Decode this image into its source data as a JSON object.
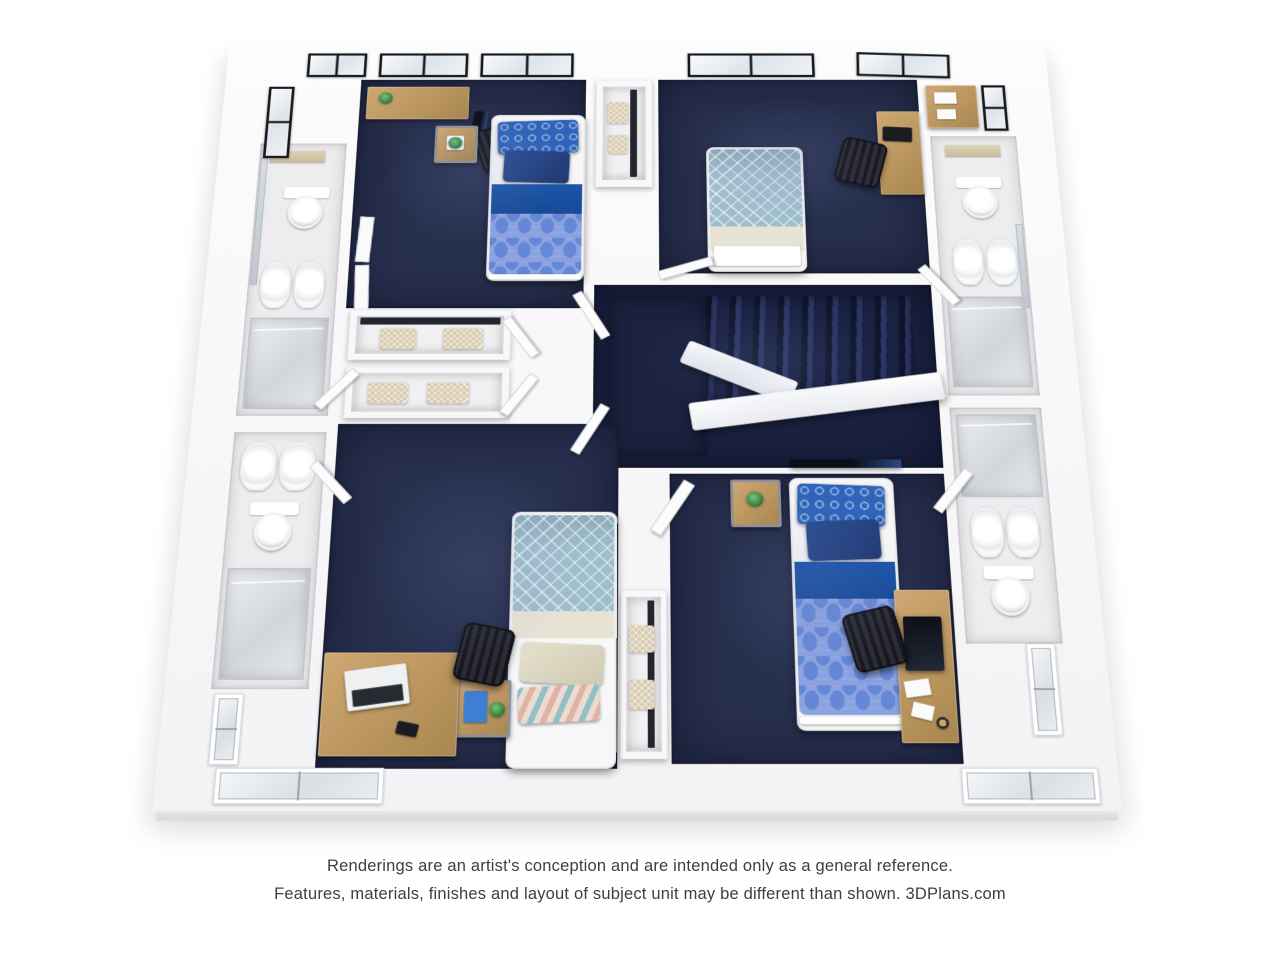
{
  "caption": {
    "line1": "Renderings are an artist's conception and are intended only as a general reference.",
    "line2": "Features, materials, finishes and layout of subject unit may be different than shown. 3DPlans.com"
  },
  "colors": {
    "page_bg": "#ffffff",
    "caption_text": "#3e3e3e",
    "carpet": "#28304f",
    "carpet_dark": "#1b2240",
    "tile": "#ededf0",
    "wood": "#cfa873",
    "wood_dark": "#a9864f",
    "frame_dark": "#17181d",
    "bed_band_blue": "#1c55a8",
    "quilt_base": "#8ba2e0",
    "quilt_cell": "#6487d6",
    "pillow_pattern_blue": "#3064ba",
    "pillow_solid_navy": "#2a4d94",
    "teal_blanket": "#9fbecd",
    "cream": "#e7e3d4",
    "basket_tan": "#d8cbb0",
    "plant_green": "#3f8a45",
    "accent_teal": "#8fc0c4",
    "accent_pink": "#e0b2a5"
  }
}
